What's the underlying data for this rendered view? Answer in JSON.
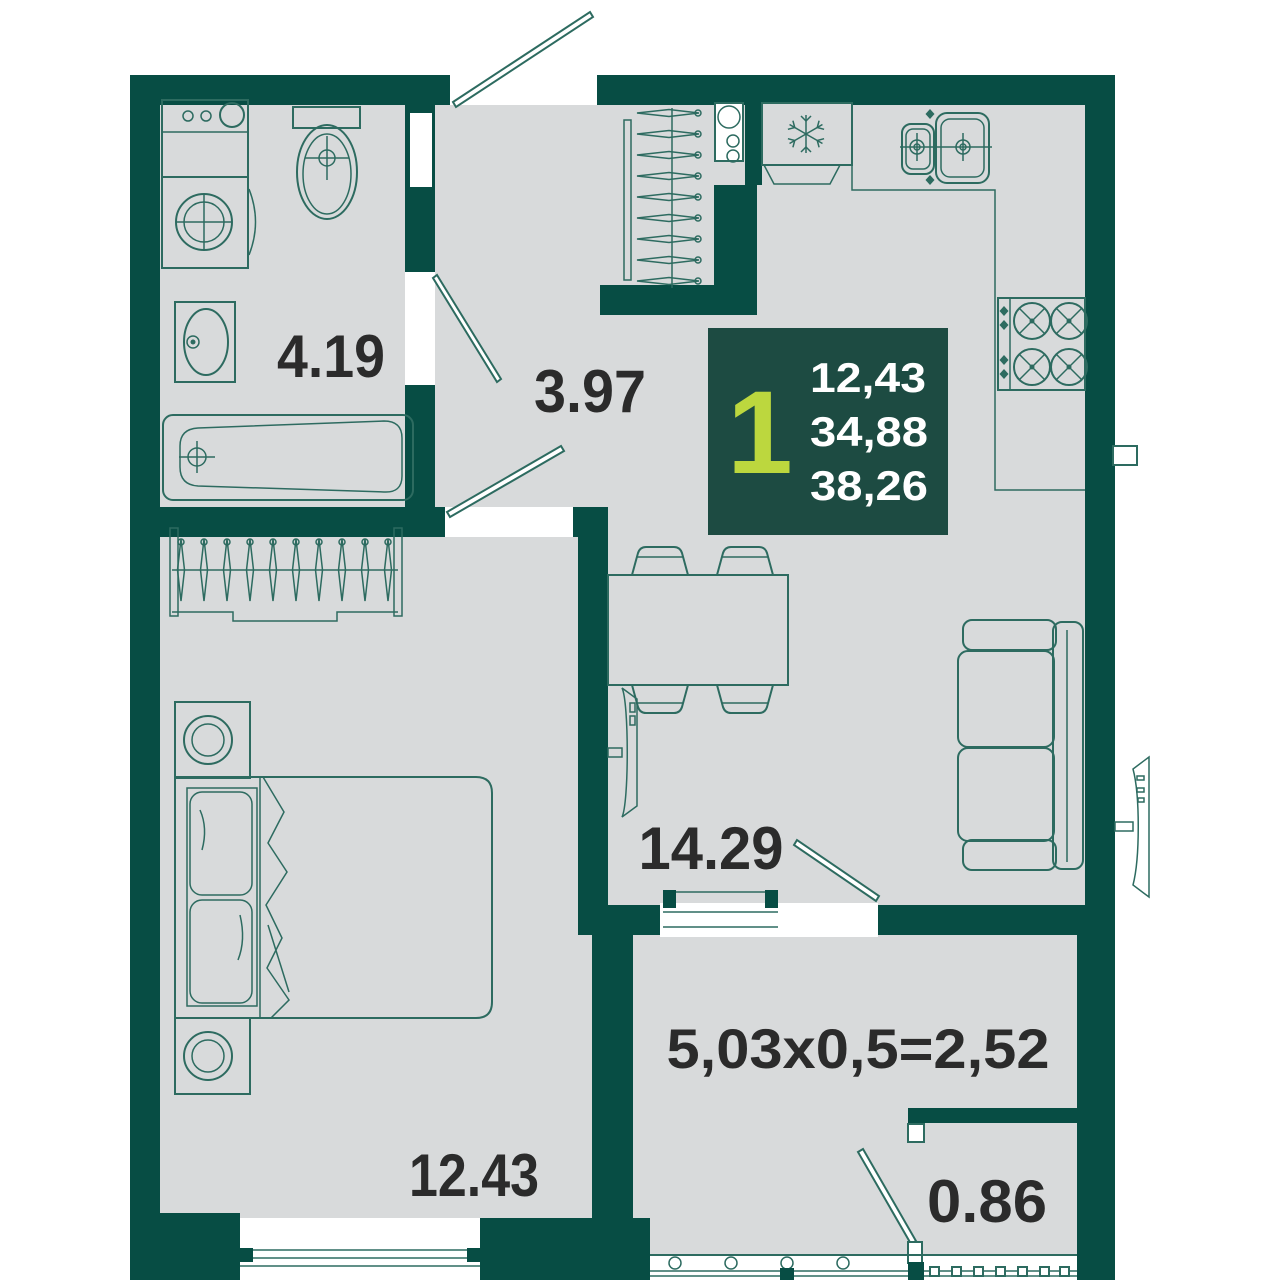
{
  "plan": {
    "kind": "apartment-floor-plan",
    "labels": {
      "bathroom": "4.19",
      "hallway": "3.97",
      "living_kitchen": "14.29",
      "bedroom": "12.43",
      "balcony_formula": "5,03x0,5=2,52",
      "storage": "0.86"
    },
    "info_box": {
      "rooms_count": "1",
      "line1": "12,43",
      "line2": "34,88",
      "line3": "38,26"
    },
    "colors": {
      "wall": "#074d44",
      "floor": "#d8dadb",
      "outline": "#2d6b60",
      "label": "#2b2b2b",
      "info_bg": "#1d4b42",
      "accent": "#bcd73e",
      "info_text": "#ffffff",
      "bg": "#ffffff"
    },
    "fixtures": {
      "bathroom": [
        "washing-machine-icon",
        "dryer-icon",
        "washbasin-icon",
        "toilet-icon",
        "bathtub-icon"
      ],
      "entry": [
        "coat-rack-icon",
        "water-heater-icon"
      ],
      "kitchen": [
        "fridge-icon",
        "snowflake-icon",
        "kitchen-sink-icon",
        "stove-icon"
      ],
      "living_room": [
        "dining-table-icon",
        "chair-icon",
        "sofa-icon",
        "tv-icon"
      ],
      "bedroom": [
        "wardrobe-icon",
        "bed-icon",
        "nightstand-icon"
      ],
      "exterior": [
        "ac-unit-icon",
        "vent-icon"
      ],
      "doors": [
        "entrance-door",
        "bathroom-door",
        "bedroom-door",
        "balcony-door",
        "storage-door"
      ]
    }
  }
}
